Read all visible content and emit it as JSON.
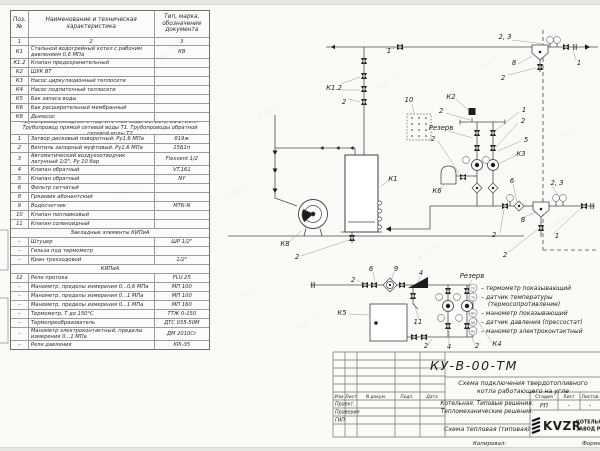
{
  "table": {
    "headers": {
      "pos": "Поз.\n№",
      "name": "Наименование и техническая\nхарактеристика",
      "type": "Тип, марка,\nобозначение\nдокумента"
    },
    "col_numbers": [
      "1",
      "2",
      "3"
    ],
    "rows": [
      {
        "pos": "К1",
        "name": "Стальной водогрейный котел с рабочим давлением 0,6 МПа",
        "type": "КВ",
        "h": 2
      },
      {
        "pos": "К1.2",
        "name": "Клапан предохранительный",
        "type": ""
      },
      {
        "pos": "К2",
        "name": "ШУК ВТ",
        "type": ""
      },
      {
        "pos": "К3",
        "name": "Насос циркуляционный теплосети",
        "type": ""
      },
      {
        "pos": "К4",
        "name": "Насос подпиточный теплосети",
        "type": ""
      },
      {
        "pos": "К5",
        "name": "Бак запаса воды",
        "type": ""
      },
      {
        "pos": "К6",
        "name": "Бак расширительный мембранный",
        "type": ""
      },
      {
        "pos": "К8",
        "name": "Дымосос",
        "type": ""
      },
      {
        "section": "Трубопровод исходной и подпиточной воды В1, В1.1, В1.2, В1.3. Трубопровод прямой сетевой воды Т1. Трубопроводы обратной сетевой воды Т2",
        "h": 2
      },
      {
        "pos": "1",
        "name": "Затвор дисковый поворотный. Ру1,6 МПа",
        "type": "б19ж"
      },
      {
        "pos": "2",
        "name": "Вентиль запорный муфтовый. Ру1,6 МПа",
        "type": "15Б1п"
      },
      {
        "pos": "3",
        "name": "Автоматический воздухоотводчик латунный 1/2\", Ру 10 бар",
        "type": "Flexvent 1/2",
        "h": 2
      },
      {
        "pos": "4",
        "name": "Клапан обратный",
        "type": "VT.161"
      },
      {
        "pos": "5",
        "name": "Клапан обратный",
        "type": "NY"
      },
      {
        "pos": "6",
        "name": "Фильтр сетчатый",
        "type": ""
      },
      {
        "pos": "8",
        "name": "Грязевик абонентский",
        "type": ""
      },
      {
        "pos": "9",
        "name": "Водосчетчик",
        "type": "МТК-N"
      },
      {
        "pos": "10",
        "name": "Клапан поплавковый",
        "type": ""
      },
      {
        "pos": "11",
        "name": "Клапан соленоидный",
        "type": ""
      },
      {
        "section": "Закладные элементы КИПиА"
      },
      {
        "pos": "–",
        "name": "Штуцер",
        "type": "ШР 1/2\""
      },
      {
        "pos": "–",
        "name": "Гильза под термометр",
        "type": ""
      },
      {
        "pos": "–",
        "name": "Кран трехходовой",
        "type": "1/2\""
      },
      {
        "section": "КИПиА"
      },
      {
        "pos": "12",
        "name": "Реле протока",
        "type": "FLU 25"
      },
      {
        "pos": "–",
        "name": "Манометр, пределы измерения 0...0,6 МПа",
        "type": "МП 100"
      },
      {
        "pos": "–",
        "name": "Манометр, пределы измерения 0...1 МПа",
        "type": "МП 100"
      },
      {
        "pos": "–",
        "name": "Манометр, пределы измерения 0...1 МПа",
        "type": "МП 160"
      },
      {
        "pos": "–",
        "name": "Термометр, Т до 150°С",
        "type": "ТТЖ 0-150"
      },
      {
        "pos": "–",
        "name": "Термопреобразователь",
        "type": "ДТС 035-50М"
      },
      {
        "pos": "–",
        "name": "Манометр электроконтактный, пределы измерения 0...1 МПа",
        "type": "ДМ 2010Сг",
        "h": 2
      },
      {
        "pos": "–",
        "name": "Реле давления",
        "type": "KPI-35"
      }
    ]
  },
  "diagram": {
    "labels": [
      {
        "text": "1",
        "x": 389,
        "y": 53
      },
      {
        "text": "2, 3",
        "x": 505,
        "y": 39
      },
      {
        "text": "8",
        "x": 514,
        "y": 65
      },
      {
        "text": "2",
        "x": 503,
        "y": 80
      },
      {
        "text": "1",
        "x": 579,
        "y": 65
      },
      {
        "text": "К1.2",
        "x": 334,
        "y": 90
      },
      {
        "text": "2",
        "x": 344,
        "y": 104
      },
      {
        "text": "10",
        "x": 409,
        "y": 102
      },
      {
        "text": "К2",
        "x": 451,
        "y": 99
      },
      {
        "text": "2",
        "x": 441,
        "y": 113
      },
      {
        "text": "1",
        "x": 524,
        "y": 112
      },
      {
        "text": "2",
        "x": 523,
        "y": 123
      },
      {
        "text": "Резерв",
        "x": 441,
        "y": 130
      },
      {
        "text": "2",
        "x": 433,
        "y": 141
      },
      {
        "text": "5",
        "x": 526,
        "y": 142
      },
      {
        "text": "К3",
        "x": 521,
        "y": 156
      },
      {
        "text": "К6",
        "x": 437,
        "y": 193
      },
      {
        "text": "6",
        "x": 512,
        "y": 183
      },
      {
        "text": "2, 3",
        "x": 557,
        "y": 185
      },
      {
        "text": "К1",
        "x": 393,
        "y": 181
      },
      {
        "text": "8",
        "x": 523,
        "y": 222
      },
      {
        "text": "2",
        "x": 494,
        "y": 237
      },
      {
        "text": "1",
        "x": 557,
        "y": 238
      },
      {
        "text": "2",
        "x": 505,
        "y": 257
      },
      {
        "text": "К8",
        "x": 285,
        "y": 246
      },
      {
        "text": "2",
        "x": 297,
        "y": 259
      },
      {
        "text": "2",
        "x": 353,
        "y": 282
      },
      {
        "text": "6",
        "x": 371,
        "y": 271
      },
      {
        "text": "9",
        "x": 396,
        "y": 271
      },
      {
        "text": "4",
        "x": 421,
        "y": 275
      },
      {
        "text": "К5",
        "x": 342,
        "y": 315
      },
      {
        "text": "11",
        "x": 418,
        "y": 324
      },
      {
        "text": "2",
        "x": 426,
        "y": 348
      },
      {
        "text": "4",
        "x": 449,
        "y": 349
      },
      {
        "text": "2",
        "x": 477,
        "y": 348
      },
      {
        "text": "К4",
        "x": 497,
        "y": 346
      },
      {
        "text": "Резерв",
        "x": 472,
        "y": 278
      }
    ],
    "legend": [
      {
        "code": "ТП",
        "text": "– термометр показывающий"
      },
      {
        "code": "ТЕ",
        "text": "– датчик температуры",
        "text2": "(термосопротивление)"
      },
      {
        "code": "МП",
        "text": "– манометр показывающий"
      },
      {
        "code": "ДД",
        "text": "– датчик давления (прессостат)"
      },
      {
        "code": "МЭ",
        "text": "– манометр электроконтактный"
      }
    ]
  },
  "title_block": {
    "doc_number": "КУ-В-00-ТМ",
    "title_line1": "Схема подключения твердотопливного",
    "title_line2": "котла работающего на угле",
    "org_line1": "Котельная. Типовые решения.",
    "org_line2": "Тепломеханические решения.",
    "scheme_type": "Схема тепловая (типовая)",
    "stage_label": "Стадия",
    "sheet_label": "Лист",
    "sheets_label": "Листов",
    "stage_value": "РП",
    "sheet_value": "-",
    "sheets_value": "-",
    "sign_cols": [
      "Изм",
      "Лист",
      "N докум.",
      "Подп.",
      "Дата"
    ],
    "sign_rows": [
      "Проект.",
      "Проверил",
      "ГИП"
    ],
    "logo_text": "KVZR",
    "logo_right1": "КОТЕЛЬНЫЙ",
    "logo_right2": "ЗАВОД Р"
  },
  "footer": {
    "copied": "Копировал:",
    "format": "Формат"
  },
  "watermark": "kvzr.ru"
}
